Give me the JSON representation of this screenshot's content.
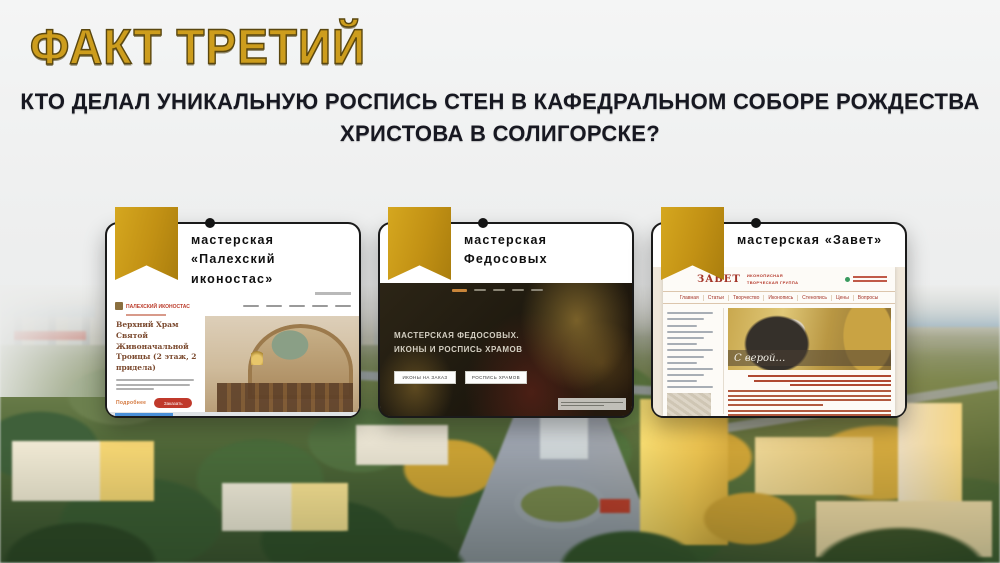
{
  "slide": {
    "title": "ФАКТ ТРЕТИЙ",
    "question": {
      "line1": "КТО ДЕЛАЛ УНИКАЛЬНУЮ РОСПИСЬ СТЕН В КАФЕДРАЛЬНОМ СОБОРЕ РОЖДЕСТВА",
      "line2": "ХРИСТОВА В СОЛИГОРСКЕ?"
    },
    "background_photo": "city-aerial-photo-soligorsk"
  },
  "colors": {
    "title_gold": "#CD9D1D",
    "title_outline": "#5A470F",
    "question_text": "#171821",
    "ribbon_gold": "#C29114",
    "card_border": "#1A1A1A",
    "site1_red": "#C0392B",
    "site2_nav_accent": "#C9853A",
    "site3_red": "#A33327",
    "photo_water": "#6F9FC0"
  },
  "cards": [
    {
      "title": "мастерская «Палехский иконостас»",
      "site": {
        "logo": "ПАЛЕХСКИЙ ИКОНОСТАС",
        "heading": "Верхний Храм Святой Живоначальной Троицы (2 этаж, 2 придела)",
        "link_label": "Подробнее",
        "button_label": "Заказать"
      }
    },
    {
      "title": "мастерская Федосовых",
      "site": {
        "hero_line1": "МАСТЕРСКАЯ ФЕДОСОВЫХ.",
        "hero_line2": "ИКОНЫ И РОСПИСЬ ХРАМОВ",
        "buttons": [
          "ИКОНЫ НА ЗАКАЗ",
          "РОСПИСЬ ХРАМОВ"
        ]
      }
    },
    {
      "title": "мастерская «Завет»",
      "site": {
        "logo": "ЗАВЕТ",
        "logo_sub1": "ИКОНОПИСНАЯ",
        "logo_sub2": "ТВОРЧЕСКАЯ ГРУППА",
        "nav": [
          "Главная",
          "Статьи",
          "Творчество",
          "Иконопись",
          "Стенопись",
          "Цены",
          "Вопросы"
        ],
        "photo_caption": "С верой…"
      }
    }
  ]
}
